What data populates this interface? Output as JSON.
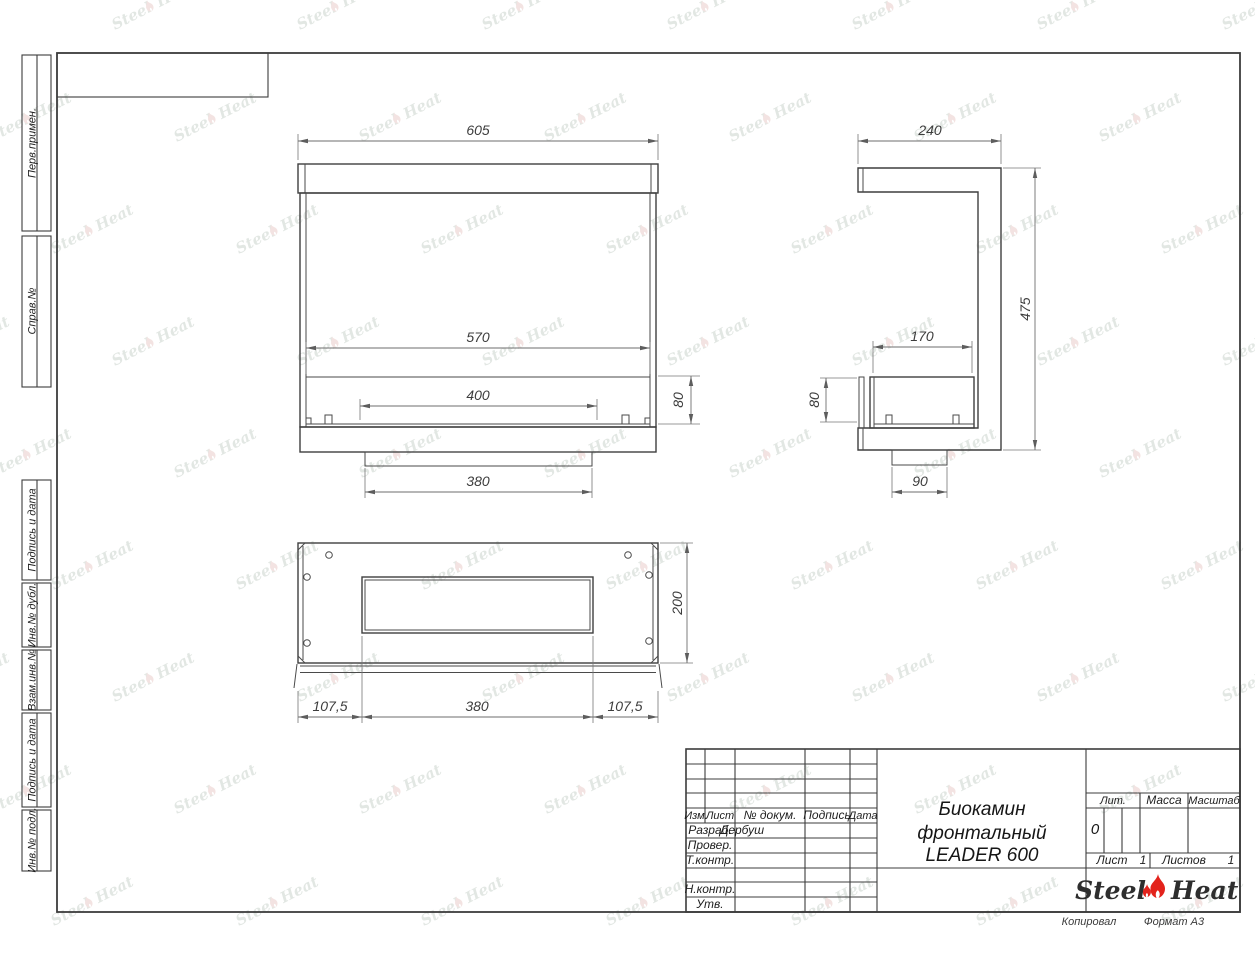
{
  "sheet": {
    "copied_label": "Копировал",
    "format_label": "Формат А3"
  },
  "margin_labels": [
    "Перв.примен.",
    "Справ.№",
    "Подпись и дата",
    "Инв.№ дубл.",
    "Взам.инв.№",
    "Подпись и дата",
    "Инв.№ подл."
  ],
  "title_block": {
    "header": {
      "izm": "Изм.",
      "list": "Лист",
      "doc": "№ докум.",
      "sign": "Подпись",
      "date": "Дата"
    },
    "rows": {
      "developed_label": "Разраб.",
      "developed_value": "Дербуш",
      "checked_label": "Провер.",
      "tcontrol_label": "Т.контр.",
      "ncontrol_label": "Н.контр.",
      "approved_label": "Утв."
    },
    "title_line1": "Биокамин",
    "title_line2": "фронтальный",
    "title_line3": "LEADER 600",
    "lit_label": "Лит.",
    "lit_value": "0",
    "mass_label": "Масса",
    "scale_label": "Масштаб",
    "sheet_label": "Лист",
    "sheet_value": "1",
    "sheets_label": "Листов",
    "sheets_value": "1",
    "logo_steel": "Steel",
    "logo_heat": "Heat"
  },
  "views": {
    "front": {
      "dims": {
        "overall_width": "605",
        "opening_width": "570",
        "burner_width": "400",
        "burner_height": "80",
        "tray_width": "380"
      }
    },
    "side": {
      "dims": {
        "overall_depth": "240",
        "overall_height": "475",
        "burner_depth": "170",
        "burner_height": "80",
        "foot_width": "90"
      }
    },
    "bottom": {
      "dims": {
        "overall_depth": "200",
        "left_offset": "107,5",
        "tray_width": "380",
        "right_offset": "107,5"
      }
    }
  },
  "watermark": {
    "steel": "Steel",
    "heat": "Heat"
  }
}
